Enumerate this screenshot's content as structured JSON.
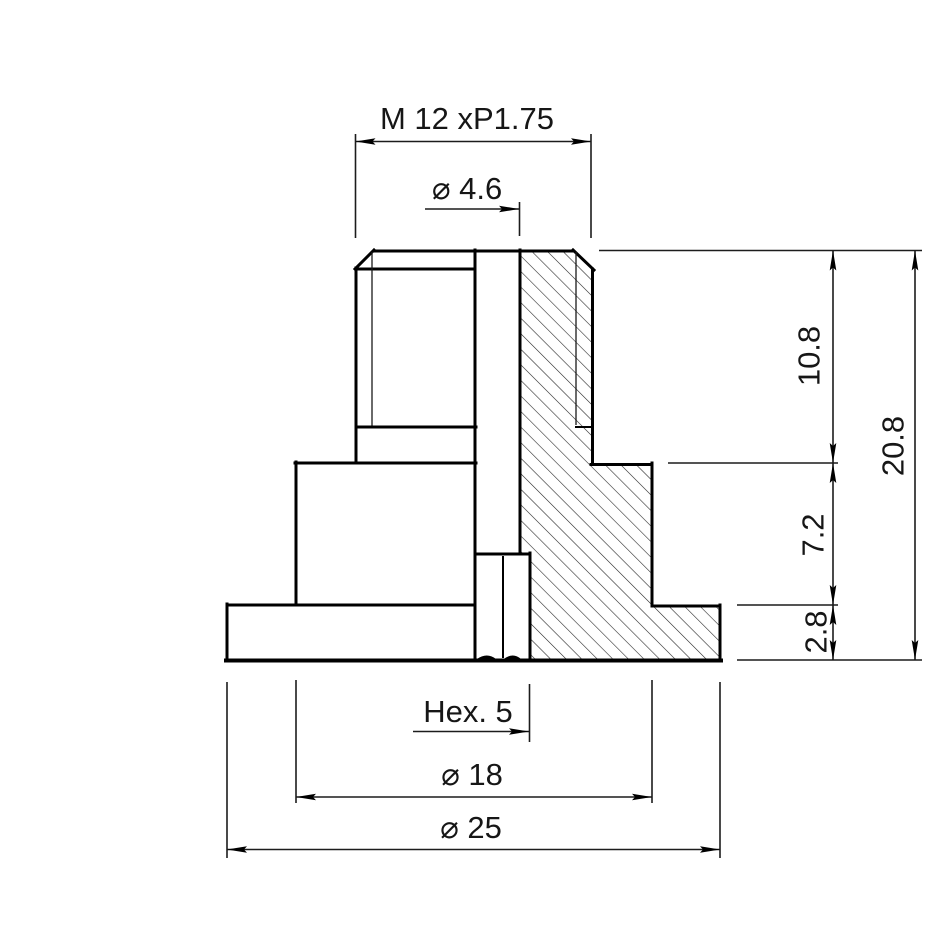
{
  "drawing": {
    "type": "engineering-section-view",
    "part": "flanged threaded bushing half-section",
    "colors": {
      "line": "#000000",
      "background": "#ffffff",
      "text": "#161616"
    },
    "dimensions": {
      "thread_spec": "M 12 xP1.75",
      "bore_diameter": "⌀ 4.6",
      "upper_height": "10.8",
      "total_height": "20.8",
      "middle_height": "7.2",
      "flange_height": "2.8",
      "hex_socket": "Hex. 5",
      "boss_diameter": "⌀ 18",
      "flange_diameter": "⌀ 25"
    }
  }
}
